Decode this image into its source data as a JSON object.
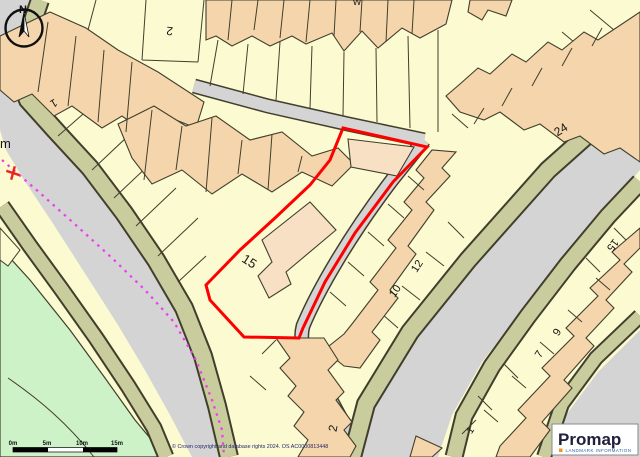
{
  "map": {
    "compass_north": "N",
    "labels": [
      {
        "text": "1"
      },
      {
        "text": "2"
      },
      {
        "text": "15"
      },
      {
        "text": "10"
      },
      {
        "text": "12"
      },
      {
        "text": "24"
      },
      {
        "text": "15"
      },
      {
        "text": "9"
      },
      {
        "text": "7"
      },
      {
        "text": "1"
      },
      {
        "text": "2"
      },
      {
        "text": "m"
      },
      {
        "text": "W"
      }
    ],
    "scale_bar": {
      "ticks": [
        "0m",
        "5m",
        "10m",
        "15m"
      ]
    },
    "copyright": "© Crown copyright and database rights 2024. OS AC0000813448",
    "logo": {
      "brand": "Promap",
      "tagline": "LANDMARK INFORMATION"
    },
    "colors": {
      "parcel": "#FBFAD0",
      "building": "#F5D6AC",
      "building_light": "#F8E0C4",
      "road": "#D4D4D4",
      "verge": "#C9CC9D",
      "green_space": "#CDF2C8",
      "line": "#413E2C",
      "plot_outline": "#FF0000",
      "boundary_dashed": "#EE3FEE",
      "marker_red": "#E8251F"
    }
  }
}
